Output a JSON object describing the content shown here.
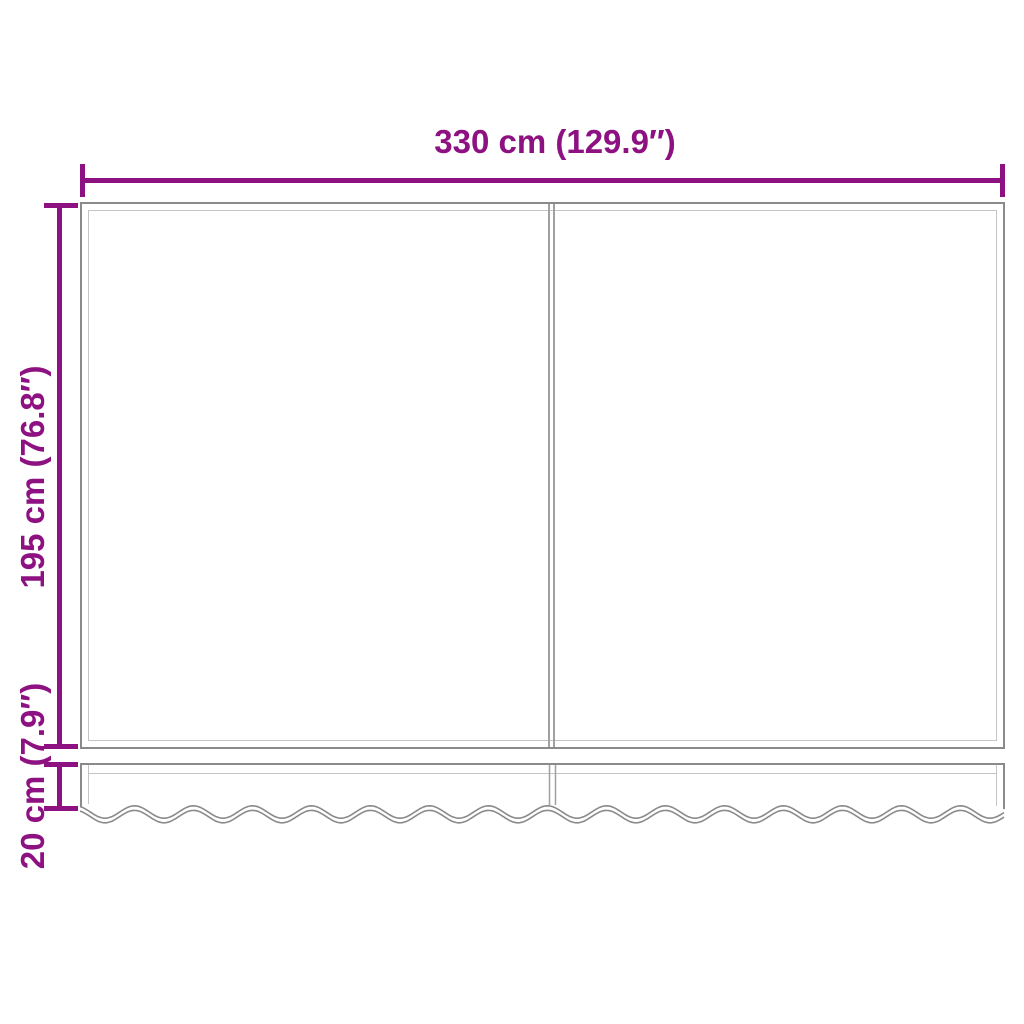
{
  "diagram": {
    "dimensions": {
      "width": {
        "label": "330 cm (129.9″)"
      },
      "height": {
        "label": "195 cm (76.8″)"
      },
      "valance_height": {
        "label": "20 cm (7.9″)"
      }
    },
    "colors": {
      "dimension_accent": "#8E1182",
      "outline_gray": "#8A8A8A",
      "inner_line_gray": "#C4C4C4",
      "seam_gray": "#A0A0A0"
    }
  }
}
